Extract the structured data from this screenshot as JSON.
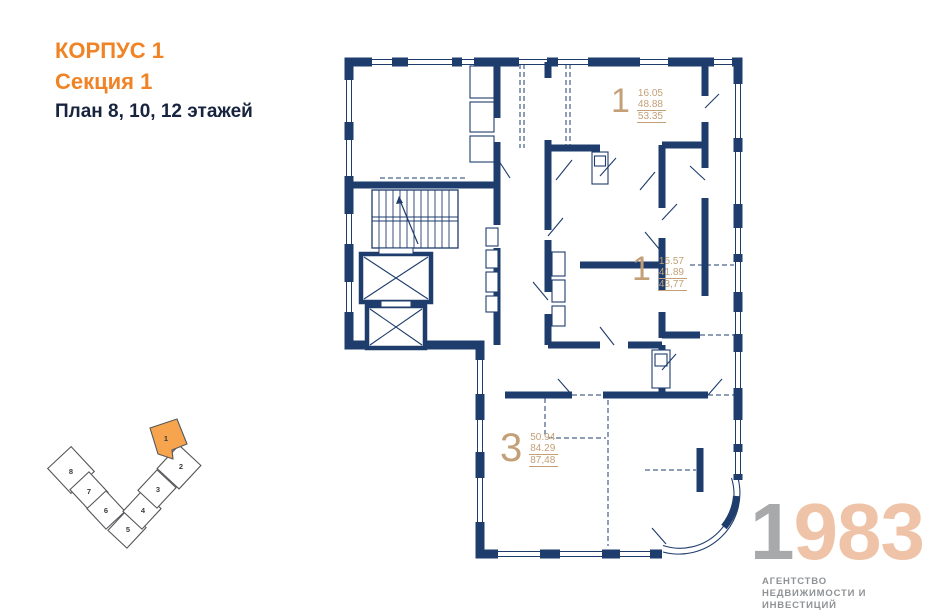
{
  "header": {
    "building": "КОРПУС 1",
    "section": "Секция 1",
    "plan": "План 8, 10, 12 этажей"
  },
  "apartments": [
    {
      "rooms": "1",
      "area_living": "16.05",
      "area_main": "48.88",
      "area_total": "53.35"
    },
    {
      "rooms": "1",
      "area_living": "15.57",
      "area_main": "41.89",
      "area_total": "43,77"
    },
    {
      "rooms": "3",
      "area_living": "50.94",
      "area_main": "84.29",
      "area_total": "87,48"
    }
  ],
  "section_key": {
    "sections": [
      "1",
      "2",
      "3",
      "4",
      "5",
      "6",
      "7",
      "8"
    ],
    "highlighted": "1",
    "highlight_color": "#f6a54e"
  },
  "logo": {
    "year_first": "1",
    "year_rest": "983",
    "tagline_line1": "АГЕНТСТВО",
    "tagline_line2": "НЕДВИЖИМОСТИ И ИНВЕСТИЦИЙ"
  },
  "colors": {
    "wall": "#1e3c6c",
    "accent_orange": "#f08326",
    "label_tan": "#c3a077",
    "logo_gray": "#a7a9aa",
    "logo_salmon": "#efc3a7"
  }
}
